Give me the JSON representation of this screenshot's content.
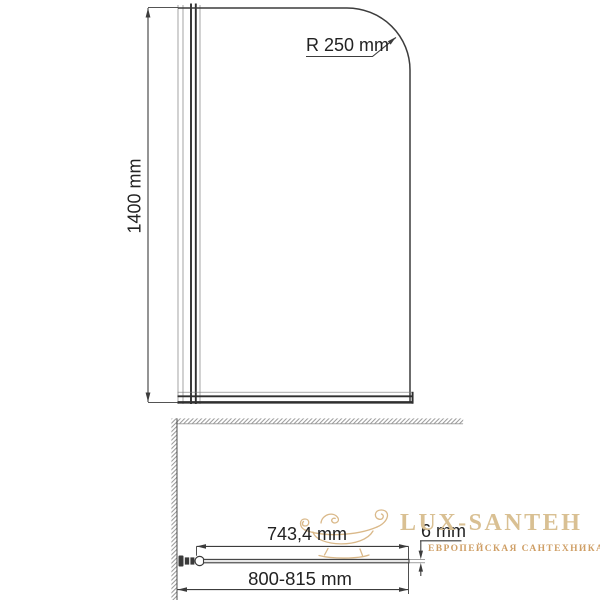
{
  "front_view": {
    "radius_label": "R 250 mm",
    "height_label": "1400 mm"
  },
  "plan_view": {
    "glass_width_label": "743,4 mm",
    "thickness_label": "6 mm",
    "width_range_label": "800-815 mm"
  },
  "watermark": {
    "brand": "LUX-SANTEH",
    "tagline": "ЕВРОПЕЙСКАЯ САНТЕХНИКА",
    "logo_icon": "bathtub-icon",
    "brand_color": "#d9c093",
    "tagline_color": "#cf9f66",
    "logo_color": "#d8b584"
  },
  "colors": {
    "background": "#ffffff",
    "line": "#3c3c3c",
    "light_line": "#9a9a9a",
    "hatch": "#9b9b9b",
    "text": "#222222"
  }
}
